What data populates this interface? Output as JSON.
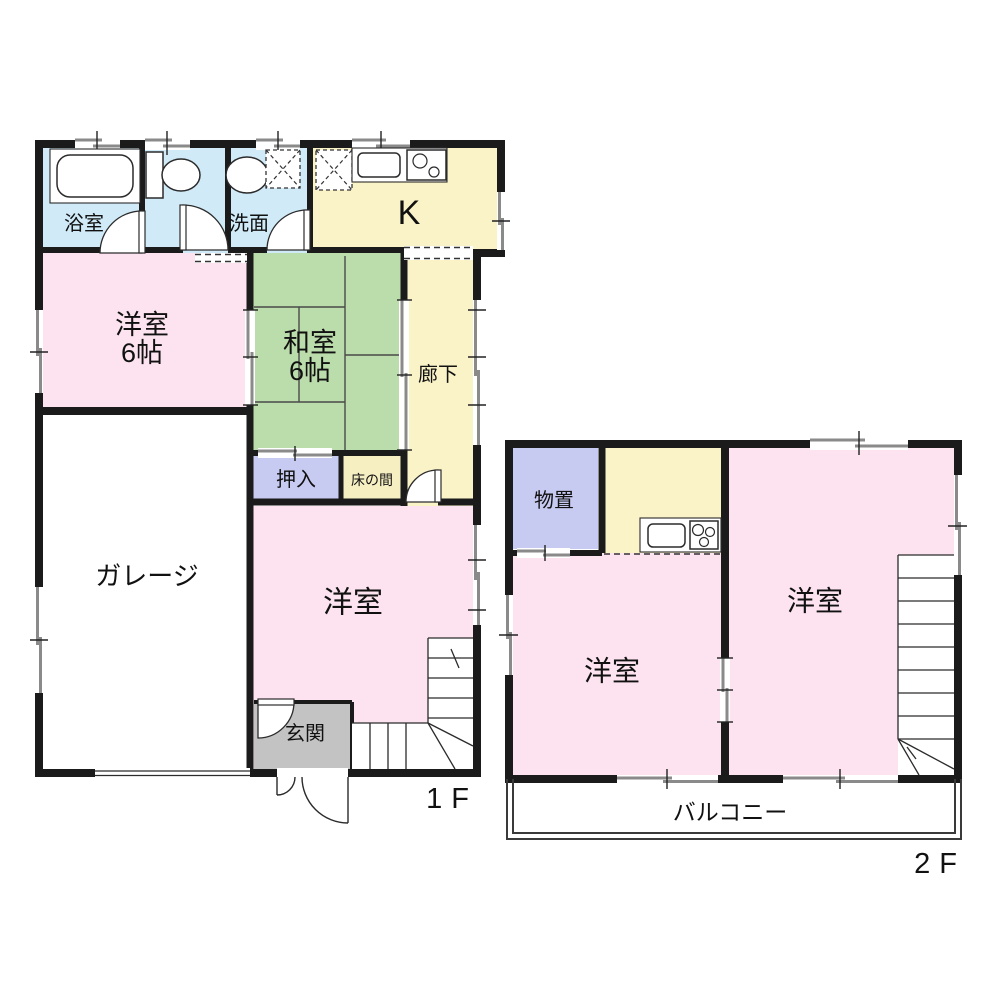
{
  "palette": {
    "wall": "#1b1b1b",
    "room_pink": "#fce3ef",
    "tatami_green": "#bbdcab",
    "water_blue": "#d0eaf8",
    "kitchen_yellow": "#faf3c8",
    "closet_lavender": "#c7caf1",
    "tokonoma_yellow": "#f6efc2",
    "entrance_gray": "#c3c3c3",
    "window_gray": "#8a8a8a",
    "white": "#ffffff"
  },
  "floor1": {
    "label": "1F",
    "rooms": {
      "bathroom": {
        "label": "浴室"
      },
      "washroom": {
        "label": "洗面"
      },
      "kitchen": {
        "label": "K"
      },
      "western_room_6": {
        "label": "洋室",
        "size": "6帖"
      },
      "japanese_room_6": {
        "label": "和室",
        "size": "6帖"
      },
      "corridor": {
        "label": "廊下"
      },
      "oshiire_closet": {
        "label": "押入"
      },
      "tokonoma": {
        "label": "床の間"
      },
      "garage": {
        "label": "ガレージ"
      },
      "western_room": {
        "label": "洋室"
      },
      "entrance": {
        "label": "玄関"
      }
    }
  },
  "floor2": {
    "label": "2F",
    "rooms": {
      "storage": {
        "label": "物置"
      },
      "western_room_left": {
        "label": "洋室"
      },
      "western_room_right": {
        "label": "洋室"
      },
      "balcony": {
        "label": "バルコニー"
      }
    }
  }
}
